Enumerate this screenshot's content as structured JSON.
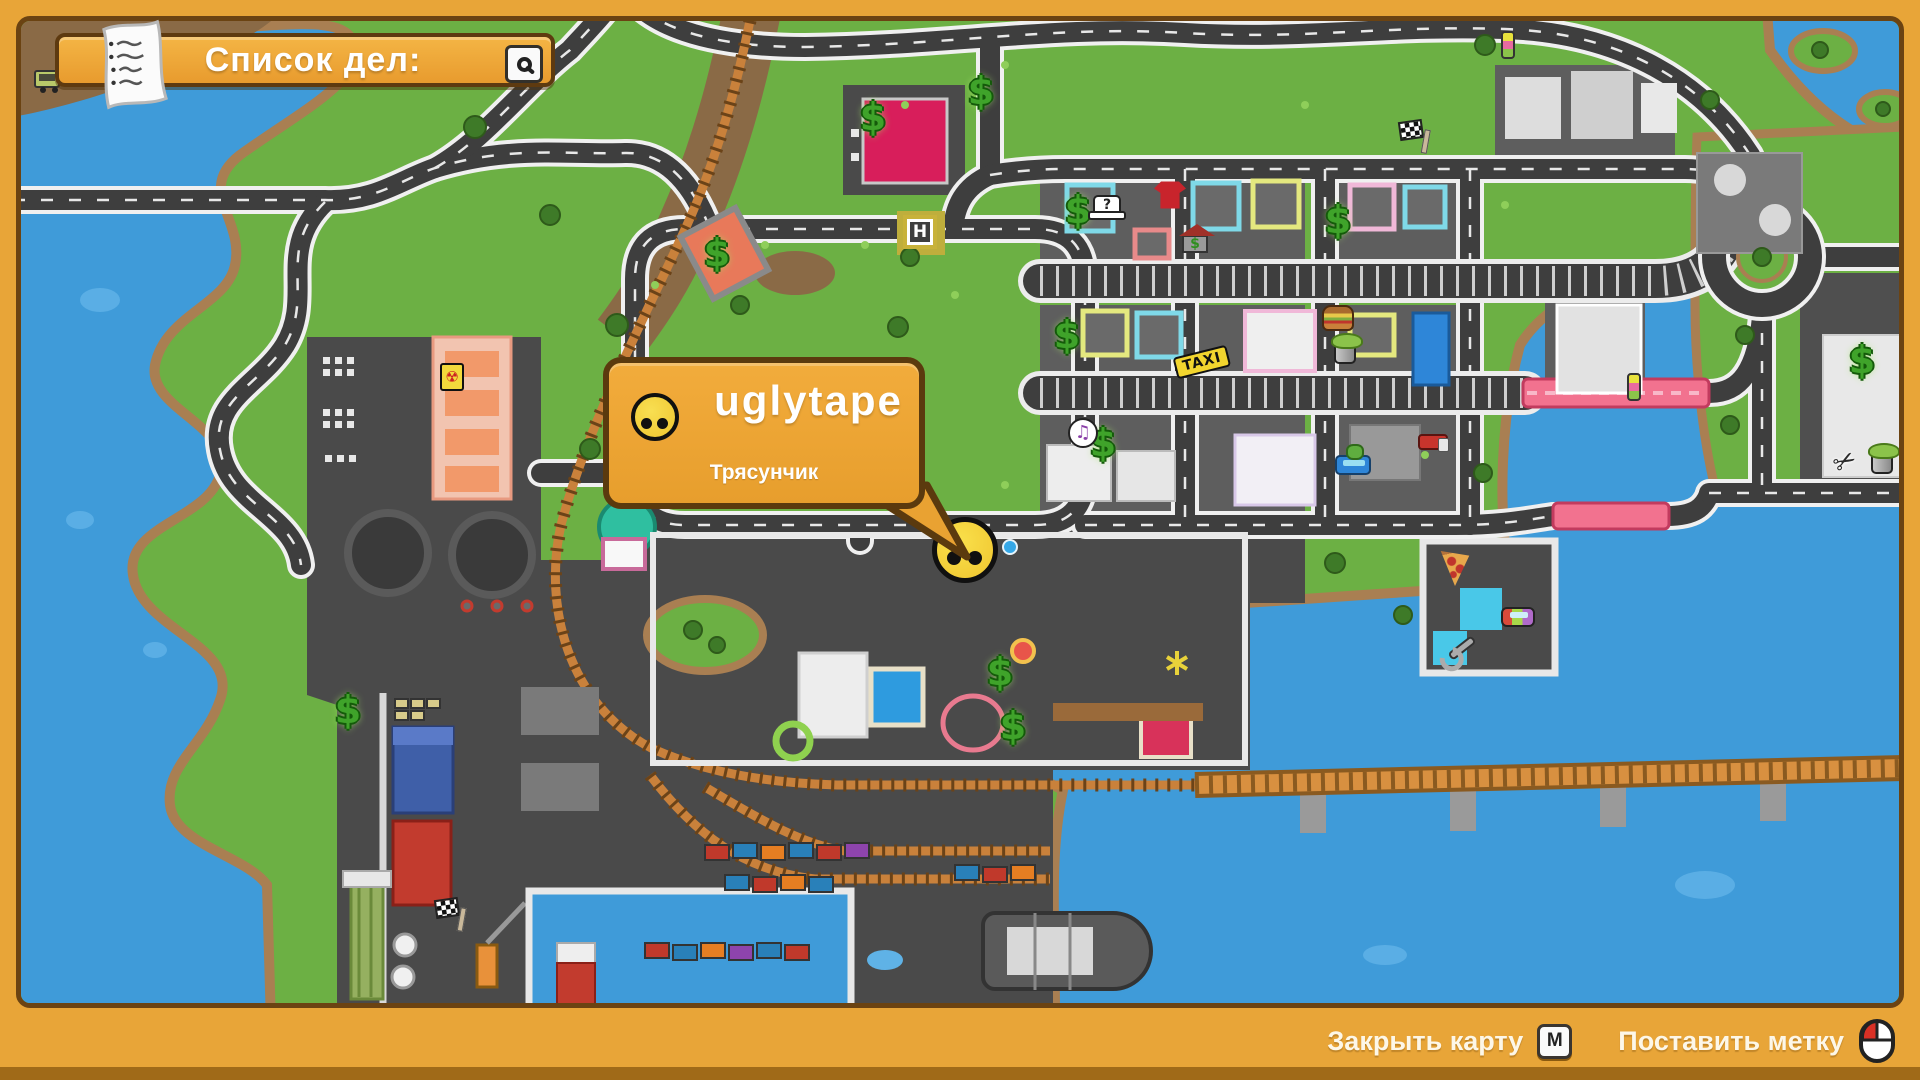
{
  "colors": {
    "frame": "#E8A538",
    "frame_bottom_strip": "#A06A18",
    "panel": "#F0AA3C",
    "panel_border": "#5E3A10",
    "water": "#3F9BD9",
    "land": "#6CB044",
    "shore": "#A97F52",
    "road": "#3E3E3E",
    "dark_zone": "#4A4A4A",
    "rail": "#C9813B",
    "dollar_green": "#3FA32A",
    "text": "#FFFFFF"
  },
  "todo_banner": {
    "label": "Список дел:",
    "left_icon": "note-icon",
    "right_icon": "magnifier-icon"
  },
  "player_bubble": {
    "player_name": "uglytape",
    "status": "Трясунчик",
    "icon": "smiley-face-icon"
  },
  "player_marker": {
    "x": 960,
    "y": 545
  },
  "bottom_bar": {
    "close_label": "Закрыть карту",
    "close_key": "M",
    "mark_label": "Поставить метку",
    "mark_icon": "mouse-icon"
  },
  "map": {
    "markers": [
      {
        "type": "cart",
        "x": 42,
        "y": 78
      },
      {
        "type": "dollar",
        "x": 868,
        "y": 112,
        "glyph": "$"
      },
      {
        "type": "dollar",
        "x": 712,
        "y": 248,
        "glyph": "$"
      },
      {
        "type": "dollar",
        "x": 976,
        "y": 86,
        "glyph": "$"
      },
      {
        "type": "dollar",
        "x": 1073,
        "y": 205,
        "glyph": "$"
      },
      {
        "type": "dollar",
        "x": 1333,
        "y": 215,
        "glyph": "$"
      },
      {
        "type": "dollar",
        "x": 1062,
        "y": 330,
        "glyph": "$"
      },
      {
        "type": "dollar",
        "x": 1098,
        "y": 438,
        "glyph": "$"
      },
      {
        "type": "dollar",
        "x": 1857,
        "y": 355,
        "glyph": "$"
      },
      {
        "type": "dollar",
        "x": 995,
        "y": 667,
        "glyph": "$"
      },
      {
        "type": "dollar",
        "x": 1008,
        "y": 721,
        "glyph": "$"
      },
      {
        "type": "dollar",
        "x": 343,
        "y": 705,
        "glyph": "$"
      },
      {
        "type": "hat",
        "x": 1102,
        "y": 200,
        "glyph": "?"
      },
      {
        "type": "shirt",
        "x": 1165,
        "y": 190
      },
      {
        "type": "house",
        "x": 1190,
        "y": 230,
        "glyph": "$"
      },
      {
        "type": "helipad",
        "x": 915,
        "y": 227,
        "glyph": "H"
      },
      {
        "type": "taxi",
        "x": 1197,
        "y": 357,
        "glyph": "TAXI"
      },
      {
        "type": "burger",
        "x": 1333,
        "y": 313
      },
      {
        "type": "trashbin",
        "x": 1340,
        "y": 347
      },
      {
        "type": "music",
        "x": 1078,
        "y": 428,
        "glyph": "♫"
      },
      {
        "type": "police-car",
        "x": 1348,
        "y": 460
      },
      {
        "type": "truck-red",
        "x": 1428,
        "y": 437
      },
      {
        "type": "pizza",
        "x": 1450,
        "y": 562
      },
      {
        "type": "wrench",
        "x": 1457,
        "y": 643
      },
      {
        "type": "car-rainbow",
        "x": 1513,
        "y": 612
      },
      {
        "type": "scissors",
        "x": 1840,
        "y": 457,
        "glyph": "✂"
      },
      {
        "type": "trashbin",
        "x": 1877,
        "y": 457
      },
      {
        "type": "barrel",
        "x": 447,
        "y": 372,
        "glyph": "☢"
      },
      {
        "type": "flag",
        "x": 1406,
        "y": 125
      },
      {
        "type": "flag",
        "x": 442,
        "y": 903
      },
      {
        "type": "buoy",
        "x": 1503,
        "y": 40
      },
      {
        "type": "buoy",
        "x": 1629,
        "y": 382
      },
      {
        "type": "dot-blue",
        "x": 1005,
        "y": 542
      }
    ]
  }
}
